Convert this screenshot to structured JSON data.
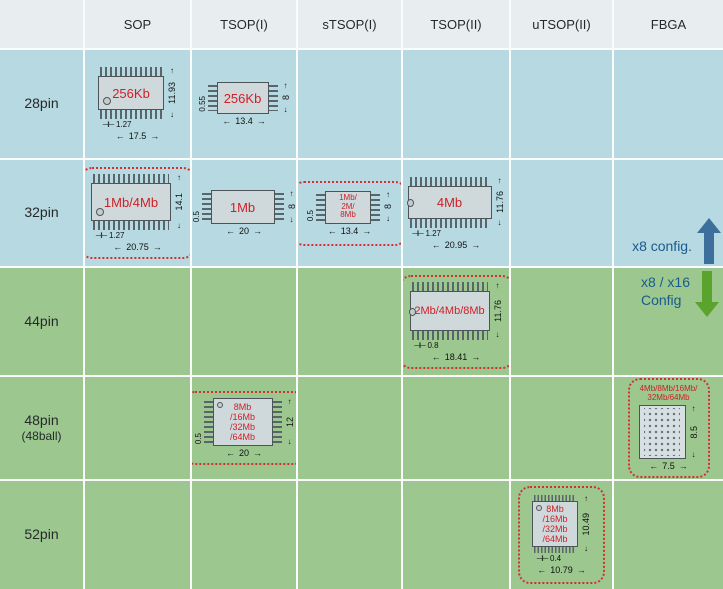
{
  "header": {
    "corner": "",
    "columns": [
      "SOP",
      "TSOP(I)",
      "sTSOP(I)",
      "TSOP(II)",
      "uTSOP(II)",
      "FBGA"
    ]
  },
  "rows": {
    "r28": {
      "label": "28pin"
    },
    "r32": {
      "label": "32pin"
    },
    "r44": {
      "label": "44pin"
    },
    "r48": {
      "label": "48pin",
      "sublabel": "(48ball)"
    },
    "r52": {
      "label": "52pin"
    }
  },
  "packages": {
    "sop_28": {
      "type": "SOP",
      "capacity": "256Kb",
      "body_height_mm": "11.93",
      "lead_pitch_mm": "1.27",
      "body_width_mm": "17.5"
    },
    "tsop1_28": {
      "type": "TSOP(I)",
      "capacity": "256Kb",
      "thickness_mm": "0.55",
      "body_height_mm": "8",
      "body_width_mm": "13.4"
    },
    "sop_32": {
      "type": "SOP",
      "capacity": "1Mb/4Mb",
      "body_height_mm": "14.1",
      "lead_pitch_mm": "1.27",
      "body_width_mm": "20.75",
      "highlighted": true
    },
    "tsop1_32": {
      "type": "TSOP(I)",
      "capacity": "1Mb",
      "thickness_mm": "0.5",
      "body_height_mm": "8",
      "body_width_mm": "20"
    },
    "stsop1_32": {
      "type": "sTSOP(I)",
      "capacity_lines": [
        "1Mb/",
        "2M/",
        "8Mb"
      ],
      "thickness_mm": "0.5",
      "body_height_mm": "8",
      "body_width_mm": "13.4",
      "highlighted": true
    },
    "tsop2_32": {
      "type": "TSOP(II)",
      "capacity": "4Mb",
      "body_height_mm": "11.76",
      "lead_pitch_mm": "1.27",
      "body_width_mm": "20.95"
    },
    "tsop2_44": {
      "type": "TSOP(II)",
      "capacity": "2Mb/4Mb/8Mb",
      "body_height_mm": "11.76",
      "lead_pitch_mm": "0.8",
      "body_width_mm": "18.41",
      "highlighted": true
    },
    "tsop1_48": {
      "type": "TSOP(I)",
      "capacity_lines": [
        "8Mb",
        "/16Mb",
        "/32Mb",
        "/64Mb"
      ],
      "thickness_mm": "0.5",
      "body_height_mm": "12",
      "body_width_mm": "20",
      "highlighted": true
    },
    "fbga_48": {
      "type": "FBGA",
      "capacity_lines": [
        "4Mb/8Mb/16Mb/",
        "32Mb/64Mb"
      ],
      "body_height_mm": "8.5",
      "body_width_mm": "7.5",
      "ball_grid": "6x8",
      "highlighted": true
    },
    "utsop2_52": {
      "type": "uTSOP(II)",
      "capacity_lines": [
        "8Mb",
        "/16Mb",
        "/32Mb",
        "/64Mb"
      ],
      "body_height_mm": "10.49",
      "lead_pitch_mm": "0.4",
      "body_width_mm": "10.79",
      "highlighted": true
    }
  },
  "annotations": {
    "x8_config": "x8 config.",
    "x8_x16_line1": "x8 / x16",
    "x8_x16_line2": "Config"
  },
  "colors": {
    "blue_row_bg": "#b7d9e1",
    "green_row_bg": "#9cc78e",
    "header_bg": "#e8eef0",
    "highlight_dotted_border": "#d43030",
    "capacity_text": "#cc2127",
    "config_text": "#1a5b8c",
    "up_arrow": "#3c6f9b",
    "down_arrow": "#5aa32c"
  }
}
